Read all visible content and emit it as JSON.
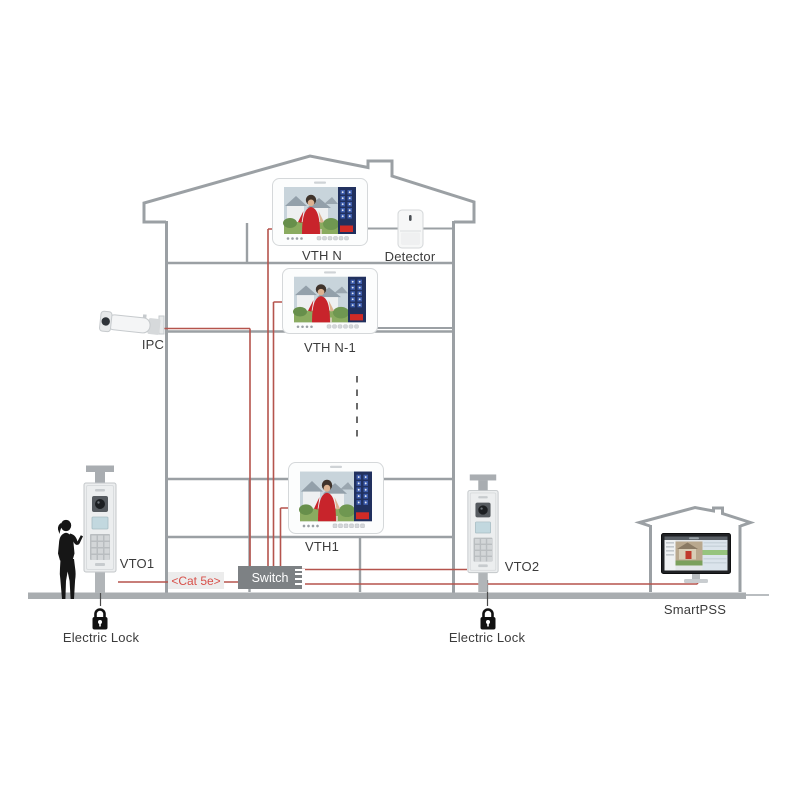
{
  "labels": {
    "vth_n": "VTH N",
    "vth_n_minus_1": "VTH N-1",
    "vth_1": "VTH1",
    "detector": "Detector",
    "ipc": "IPC",
    "vto1": "VTO1",
    "vto2": "VTO2",
    "switch": "Switch",
    "cat5e": "<Cat 5e>",
    "electric_lock_left": "Electric Lock",
    "electric_lock_right": "Electric Lock",
    "smartpss": "SmartPSS"
  },
  "icons": {
    "electric_lock": "padlock-icon",
    "person": "person-silhouette-icon",
    "ipc": "bullet-camera-icon",
    "detector": "motion-detector-icon",
    "vth_monitor": "indoor-monitor-icon",
    "vto_station": "door-station-icon",
    "smartpss_pc": "desktop-monitor-icon"
  },
  "colors": {
    "structure": "#9ba0a4",
    "ground": "#a9adb0",
    "wire": "#b5544d",
    "cat5e_text": "#d8504a",
    "cat5e_bg": "#ececec",
    "switch_bg": "#7d8184",
    "switch_text": "#ffffff",
    "label_text": "#3b3b3b",
    "background": "#ffffff",
    "monitor_panel_blue": "#20305e",
    "monitor_red_button": "#d02b26"
  }
}
